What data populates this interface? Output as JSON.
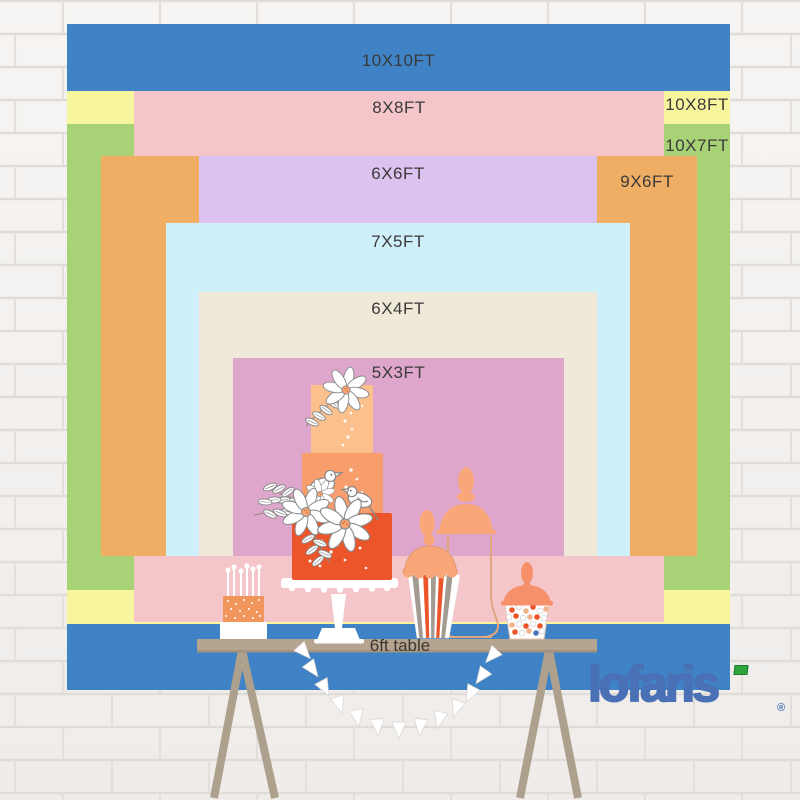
{
  "backdrop_chart": {
    "description": "nested backdrop size comparison chart",
    "layers": [
      {
        "name": "10x10ft",
        "label": "10X10FT",
        "width_ft": 10,
        "height_ft": 10,
        "color": "#3F82C5"
      },
      {
        "name": "10x8ft",
        "label": "10X8FT",
        "width_ft": 10,
        "height_ft": 8,
        "color": "#F7F59E"
      },
      {
        "name": "10x7ft",
        "label": "10X7FT",
        "width_ft": 10,
        "height_ft": 7,
        "color": "#A8D276"
      },
      {
        "name": "8x8ft",
        "label": "8X8FT",
        "width_ft": 8,
        "height_ft": 8,
        "color": "#F4C6CA"
      },
      {
        "name": "9x6ft",
        "label": "9X6FT",
        "width_ft": 9,
        "height_ft": 6,
        "color": "#EFAE63"
      },
      {
        "name": "6x6ft",
        "label": "6X6FT",
        "width_ft": 6,
        "height_ft": 6,
        "color": "#DCC2EE"
      },
      {
        "name": "7x5ft",
        "label": "7X5FT",
        "width_ft": 7,
        "height_ft": 5,
        "color": "#CFEFFA"
      },
      {
        "name": "6x4ft",
        "label": "6X4FT",
        "width_ft": 6,
        "height_ft": 4,
        "color": "#F0E9D9"
      },
      {
        "name": "5x3ft",
        "label": "5X3FT",
        "width_ft": 5,
        "height_ft": 3,
        "color": "#DFA6CB"
      }
    ],
    "table": {
      "label": "6ft table"
    }
  },
  "brand": {
    "logo_text": "lofaris",
    "registered_mark": "®",
    "logo_color": "#4A70B6",
    "flag_color": "#2EA43C"
  },
  "illustrations": {
    "items": [
      "white-brick-wall",
      "three-tier-cake",
      "white-sketch-flowers",
      "sketch-birds",
      "mini-cake-with-candles",
      "striped-candy-cup",
      "glass-candy-jar",
      "apothecary-candy-jar",
      "pennant-garland",
      "wooden-trestle-table"
    ]
  }
}
